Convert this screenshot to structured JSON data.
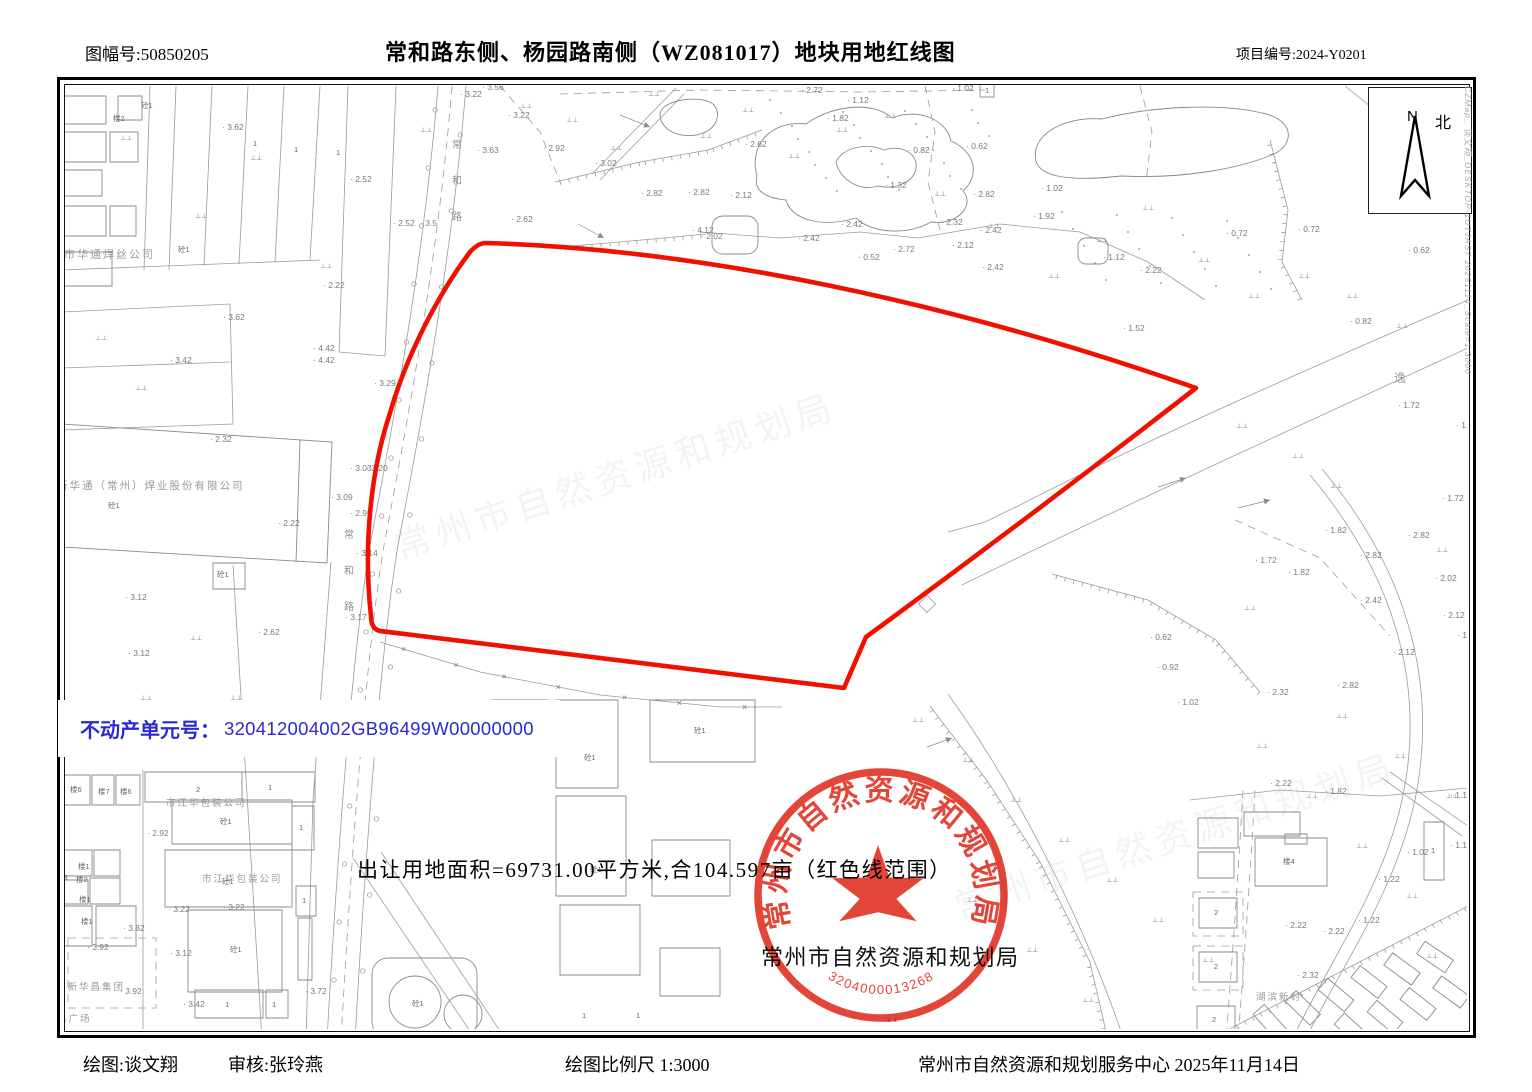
{
  "header": {
    "sheet_no": "图幅号:50850205",
    "title": "常和路东侧、杨园路南侧（WZ081017）地块用地红线图",
    "project_no": "项目编号:2024-Y0201"
  },
  "footer": {
    "drafter": "绘图:谈文翔",
    "checker": "审核:张玲燕",
    "scale": "绘图比例尺  1:3000",
    "agency_date": "常州市自然资源和规划服务中心  2025年11月14日"
  },
  "parcel_info": {
    "unit_label": "不动产单元号：",
    "unit_value": "320412004002GB96499W00000000",
    "area_note": "出让用地面积=69731.00平方米,合104.597亩（红色线范围）"
  },
  "stamp": {
    "org": "常州市自然资源和规划局",
    "serial": "3204000013268",
    "org_caption": "常州市自然资源和规划局"
  },
  "compass": {
    "n": "N",
    "north": "北"
  },
  "side_note": "CZMap_ 谈文翔_DESKTOP-1UTJAS7 20251114_Scale=1:3000",
  "colors": {
    "redline": "#f01000",
    "blue": "#2a2ad2",
    "stamp": "#e03022"
  },
  "map": {
    "road_name": "常和路",
    "watermark": "常州市自然资源和规划局",
    "company_labels": [
      [
        "市华通焊丝公司",
        64,
        258,
        11
      ],
      [
        "新华通（常州）焊业股份有限公司",
        57,
        489,
        10.5
      ],
      [
        "市江华包装公司",
        166,
        806,
        9.5
      ],
      [
        "市江华包装公司",
        202,
        882,
        9.5
      ],
      [
        "苏新华昌集团",
        56,
        990,
        9.5
      ],
      [
        "昌广场",
        57,
        1022,
        9.5
      ],
      [
        "湖滨新村",
        1256,
        1000,
        9.5
      ],
      [
        "逸",
        1394,
        382,
        12
      ]
    ],
    "elevation_labels": [
      [
        "3.62",
        222,
        130
      ],
      [
        "2.52",
        350,
        182
      ],
      [
        "3.22",
        460,
        97
      ],
      [
        "3.56",
        482,
        90
      ],
      [
        "3.22",
        508,
        118
      ],
      [
        "3.63",
        477,
        153
      ],
      [
        "2.92",
        543,
        151
      ],
      [
        "2.62",
        511,
        222
      ],
      [
        "3.5",
        420,
        226
      ],
      [
        "2.52",
        393,
        226
      ],
      [
        "2.22",
        323,
        288
      ],
      [
        "3.62",
        223,
        320
      ],
      [
        "3.42",
        170,
        363
      ],
      [
        "4.42",
        313,
        351
      ],
      [
        "4.42",
        313,
        363
      ],
      [
        "3.29",
        374,
        386
      ],
      [
        "2.32",
        210,
        442
      ],
      [
        "2.22",
        278,
        526
      ],
      [
        "3.03",
        350,
        471
      ],
      [
        "3.20",
        366,
        471
      ],
      [
        "3.09",
        331,
        500
      ],
      [
        "2.95",
        350,
        516
      ],
      [
        "3.14",
        356,
        556
      ],
      [
        "3.17",
        345,
        620
      ],
      [
        "2.62",
        258,
        635
      ],
      [
        "3.12",
        125,
        600
      ],
      [
        "3.12",
        128,
        656
      ],
      [
        "2.72",
        801,
        93
      ],
      [
        "1.12",
        847,
        103
      ],
      [
        "1.82",
        827,
        121
      ],
      [
        "1.02",
        952,
        91
      ],
      [
        "2.62",
        745,
        147
      ],
      [
        "3.02",
        595,
        166
      ],
      [
        "2.82",
        641,
        196
      ],
      [
        "2.82",
        688,
        195
      ],
      [
        "2.12",
        730,
        198
      ],
      [
        "4.12",
        692,
        233
      ],
      [
        "2.02",
        701,
        239
      ],
      [
        "2.42",
        798,
        241
      ],
      [
        "2.42",
        841,
        227
      ],
      [
        "0.52",
        858,
        260
      ],
      [
        "1.32",
        885,
        188
      ],
      [
        "0.82",
        908,
        153
      ],
      [
        "0.62",
        966,
        149
      ],
      [
        "2.82",
        973,
        197
      ],
      [
        "2.32",
        941,
        225
      ],
      [
        "2.42",
        980,
        233
      ],
      [
        "2.12",
        952,
        248
      ],
      [
        "2.42",
        982,
        270
      ],
      [
        "2.72",
        893,
        252
      ],
      [
        "1.92",
        1033,
        219
      ],
      [
        "1.02",
        1041,
        191
      ],
      [
        "1.12",
        1103,
        260
      ],
      [
        "2.22",
        1140,
        273
      ],
      [
        "1.52",
        1123,
        331
      ],
      [
        "0.72",
        1226,
        236
      ],
      [
        "0.72",
        1298,
        232
      ],
      [
        "0.62",
        1408,
        253
      ],
      [
        "0.82",
        1350,
        324
      ],
      [
        "1.72",
        1398,
        408
      ],
      [
        "1.86",
        1456,
        428
      ],
      [
        "1.72",
        1442,
        501
      ],
      [
        "1.82",
        1325,
        533
      ],
      [
        "2.82",
        1408,
        538
      ],
      [
        "2.82",
        1360,
        558
      ],
      [
        "1.72",
        1255,
        563
      ],
      [
        "1.82",
        1288,
        575
      ],
      [
        "2.02",
        1435,
        581
      ],
      [
        "2.42",
        1360,
        603
      ],
      [
        "2.12",
        1443,
        618
      ],
      [
        "1.42",
        1457,
        638
      ],
      [
        "0.62",
        1150,
        640
      ],
      [
        "0.92",
        1157,
        670
      ],
      [
        "2.12",
        1393,
        655
      ],
      [
        "2.82",
        1337,
        688
      ],
      [
        "2.32",
        1267,
        695
      ],
      [
        "1.02",
        1177,
        705
      ],
      [
        "1.12",
        1450,
        798
      ],
      [
        "1.12",
        1450,
        848
      ],
      [
        "1.02",
        1407,
        855
      ],
      [
        "1.22",
        1378,
        882
      ],
      [
        "2.22",
        1270,
        786
      ],
      [
        "1.82",
        1325,
        794
      ],
      [
        "2.22",
        1285,
        928
      ],
      [
        "2.22",
        1323,
        934
      ],
      [
        "1.22",
        1358,
        923
      ],
      [
        "2.32",
        1297,
        978
      ],
      [
        "2.92",
        147,
        836
      ],
      [
        "3.22",
        168,
        912
      ],
      [
        "3.22",
        223,
        910
      ],
      [
        "3.12",
        170,
        956
      ],
      [
        "3.92",
        87,
        950
      ],
      [
        "3.92",
        120,
        994
      ],
      [
        "3.42",
        183,
        1007
      ],
      [
        "3.72",
        305,
        994
      ],
      [
        "3.82",
        123,
        931
      ]
    ],
    "misc_labels": [
      [
        "1",
        253,
        146
      ],
      [
        "1",
        294,
        152
      ],
      [
        "1",
        336,
        155
      ],
      [
        "1",
        985,
        93
      ],
      [
        "砼1",
        141,
        108
      ],
      [
        "楼2",
        113,
        121
      ],
      [
        "砼1",
        178,
        252
      ],
      [
        "砼1",
        108,
        508
      ],
      [
        "砼1",
        217,
        577
      ],
      [
        "楼6",
        70,
        792
      ],
      [
        "楼7",
        98,
        794
      ],
      [
        "楼6",
        120,
        794
      ],
      [
        "2",
        196,
        792
      ],
      [
        "1",
        268,
        790
      ],
      [
        "砼1",
        220,
        824
      ],
      [
        "砼1",
        222,
        884
      ],
      [
        "砼1",
        230,
        952
      ],
      [
        "1",
        299,
        830
      ],
      [
        "1",
        302,
        903
      ],
      [
        "1",
        225,
        1007
      ],
      [
        "1",
        272,
        1007
      ],
      [
        "楼3",
        56,
        880
      ],
      [
        "楼1",
        78,
        869
      ],
      [
        "楼2",
        76,
        882
      ],
      [
        "楼1",
        79,
        902
      ],
      [
        "楼1",
        81,
        924
      ],
      [
        "楼4",
        1283,
        864
      ],
      [
        "2",
        1214,
        915
      ],
      [
        "2",
        1214,
        969
      ],
      [
        "2",
        1212,
        1022
      ],
      [
        "1",
        1431,
        853
      ],
      [
        "砼1",
        694,
        733
      ],
      [
        "砼1",
        584,
        760
      ],
      [
        "1",
        582,
        1018
      ],
      [
        "1",
        636,
        1018
      ],
      [
        "砼1",
        590,
        872
      ],
      [
        "砼1",
        412,
        1006
      ]
    ]
  }
}
